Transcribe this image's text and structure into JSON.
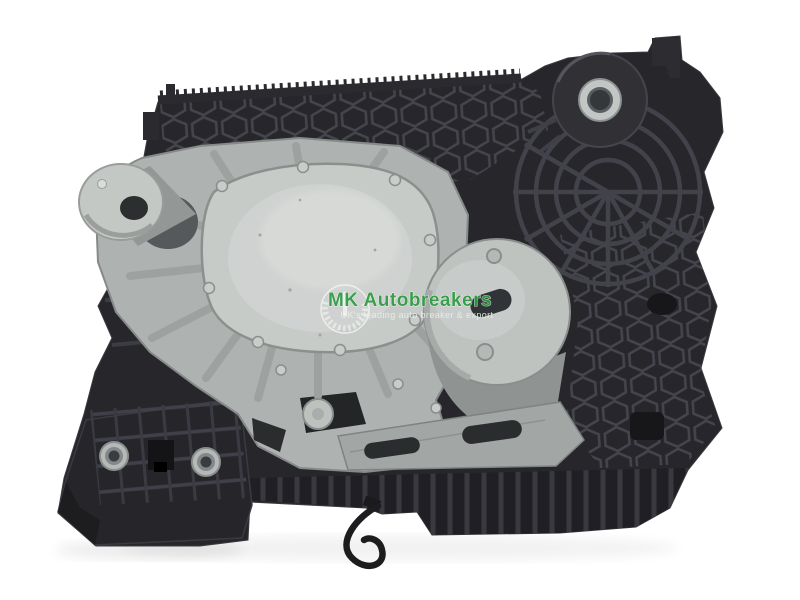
{
  "photo": {
    "subject": "Used gearbox actuator mounting bracket: black ribbed plastic housing with cast aluminium cover plate, photographed on white background",
    "background_color": "#ffffff"
  },
  "watermark": {
    "brand": "MK Autobreakers",
    "tagline": "UK's leading auto breaker & export",
    "brand_color": "#2e9b41",
    "tagline_color": "#edf1ed",
    "emblem": "laurel-wreath-emblem"
  },
  "colors": {
    "plastic_dark": "#27272b",
    "plastic_recess": "#1a1a1d",
    "plastic_rib": "#45454d",
    "aluminium_light": "#c9cdca",
    "aluminium_mid": "#aeb2b0",
    "aluminium_shadow": "#8f9391",
    "bushing_silver": "#c2c6c4",
    "bushing_bore": "#35383a"
  },
  "features": [
    "serrated-top-edge",
    "top-mount-boss-with-metal-bushing",
    "spider-web-ribbing",
    "honeycomb-ribbing",
    "aluminium-cover-plate",
    "aluminium-pivot-boss",
    "aluminium-drum-with-slot",
    "mounting-foot-with-two-bushings",
    "hanging-wire",
    "bottom-rib-band"
  ]
}
